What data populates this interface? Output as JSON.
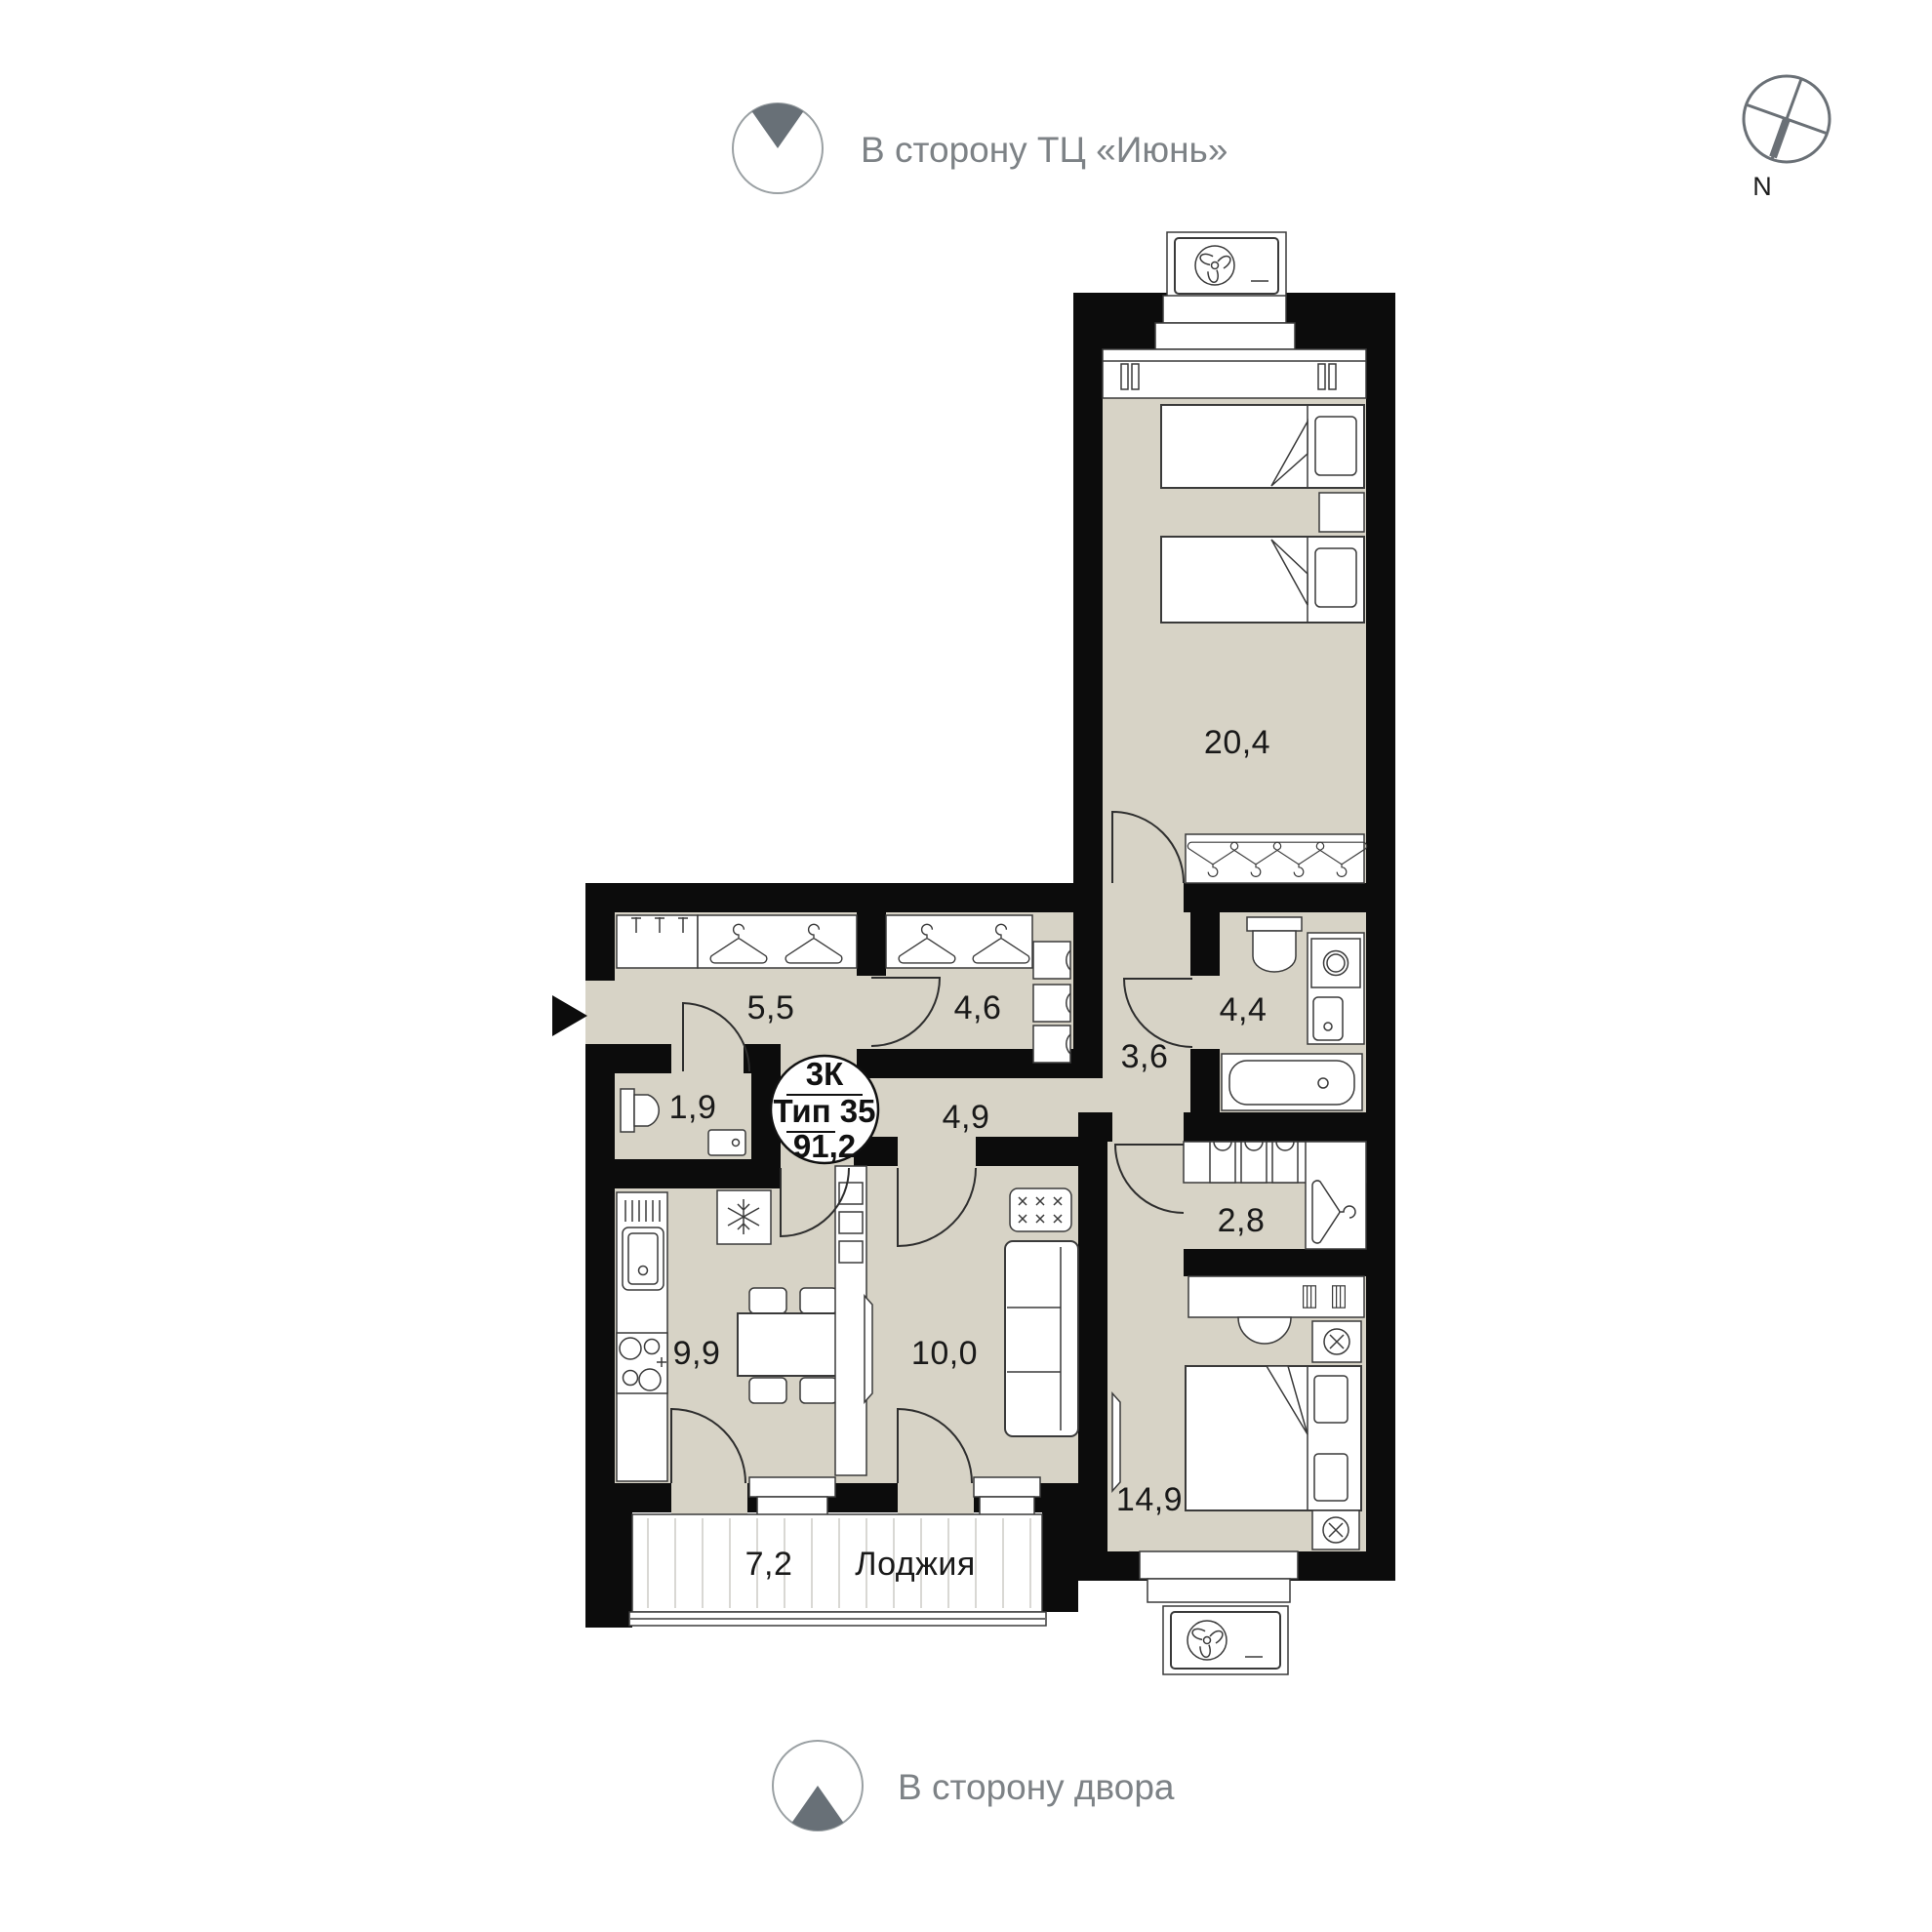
{
  "annotations": {
    "top_direction": "В сторону ТЦ «Июнь»",
    "bottom_direction": "В сторону двора",
    "compass_label": "N"
  },
  "badge": {
    "rooms_type": "3К",
    "plan_type": "Тип 35",
    "total_area": "91,2"
  },
  "plan": {
    "rooms": [
      {
        "id": "bedroom-large",
        "area": "20,4"
      },
      {
        "id": "hallway",
        "area": "5,5"
      },
      {
        "id": "closet-hall",
        "area": "4,6"
      },
      {
        "id": "bathroom",
        "area": "4,4"
      },
      {
        "id": "corridor",
        "area": "3,6"
      },
      {
        "id": "wc",
        "area": "1,9"
      },
      {
        "id": "inner-hall",
        "area": "4,9"
      },
      {
        "id": "walk-in-closet",
        "area": "2,8"
      },
      {
        "id": "kitchen",
        "area": "9,9"
      },
      {
        "id": "living-room",
        "area": "10,0"
      },
      {
        "id": "bedroom-second",
        "area": "14,9"
      },
      {
        "id": "loggia",
        "area": "7,2",
        "name": "Лоджия"
      }
    ]
  },
  "colors": {
    "wall": "#0c0c0c",
    "floor": "#d7d3c6",
    "annotation_gray": "#7d8286",
    "wedge_gray": "#687077"
  }
}
